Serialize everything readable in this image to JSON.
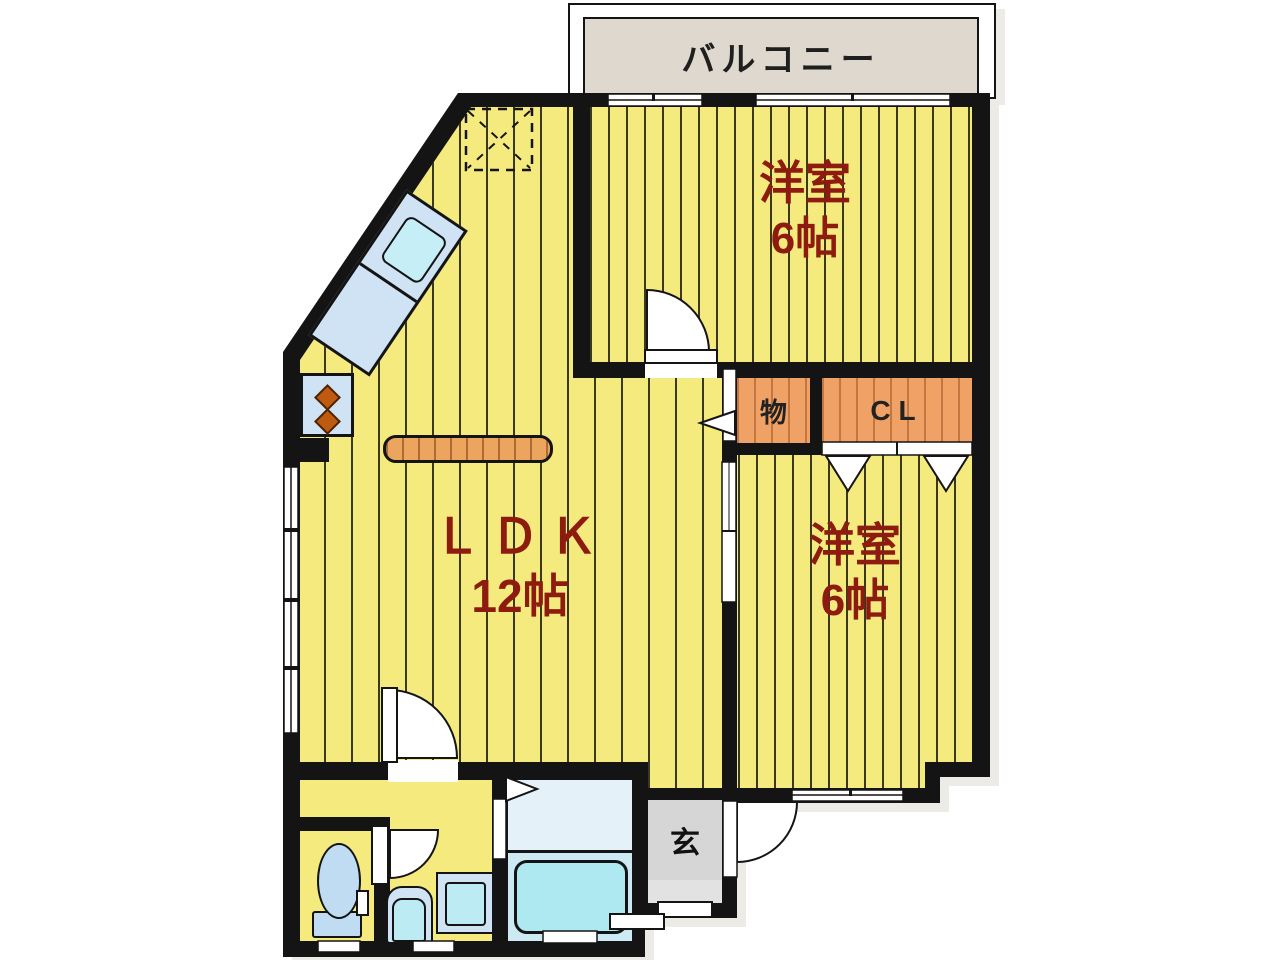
{
  "rooms": {
    "balcony": {
      "label": "バルコニー"
    },
    "bedroom_top": {
      "name": "洋室",
      "size": "6帖"
    },
    "bedroom_right": {
      "name": "洋室",
      "size": "6帖"
    },
    "ldk": {
      "name": "ＬＤＫ",
      "size": "12帖"
    },
    "storage": {
      "label": "物"
    },
    "closet": {
      "label": "CL"
    },
    "entrance": {
      "label": "玄"
    }
  },
  "colors": {
    "wall": "#141414",
    "floor_yellow": "#F4EA7D",
    "floor_stripe": "rgba(25,25,15,0.85)",
    "closet_orange": "#F0A266",
    "room_label_maroon": "#8E1B10",
    "balcony_beige": "#DFD8CE",
    "genkan_gray": "#D6D6D6",
    "fixture_blue": "#CFE3F5",
    "water_cyan": "#C5EEF6",
    "bathtub_cyan": "#AEE8F1",
    "bath_floor_blue": "#CDE9F3",
    "kitchen_counter_orange": "#EBA55E"
  }
}
